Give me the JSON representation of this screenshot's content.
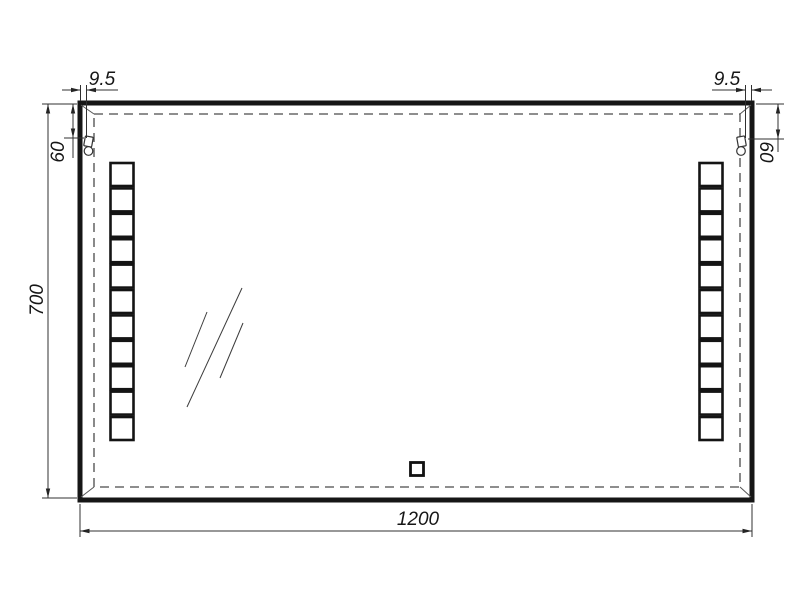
{
  "page": {
    "background": "#ffffff",
    "description": "Dimensioned technical drawing of a rectangular LED bathroom mirror, front view"
  },
  "drawing": {
    "line_color": "#161616",
    "dim_color": "#303030",
    "labels": {
      "width": "1200",
      "height": "700",
      "offset_left": "9.5",
      "offset_right": "9.5",
      "drop_left": "60",
      "drop_right": "60"
    },
    "features": {
      "led_squares_per_column": 11,
      "led_columns": 2,
      "mounting_hooks": 2,
      "glass_reflection_marks": 3,
      "touch_sensor_count": 1
    }
  }
}
